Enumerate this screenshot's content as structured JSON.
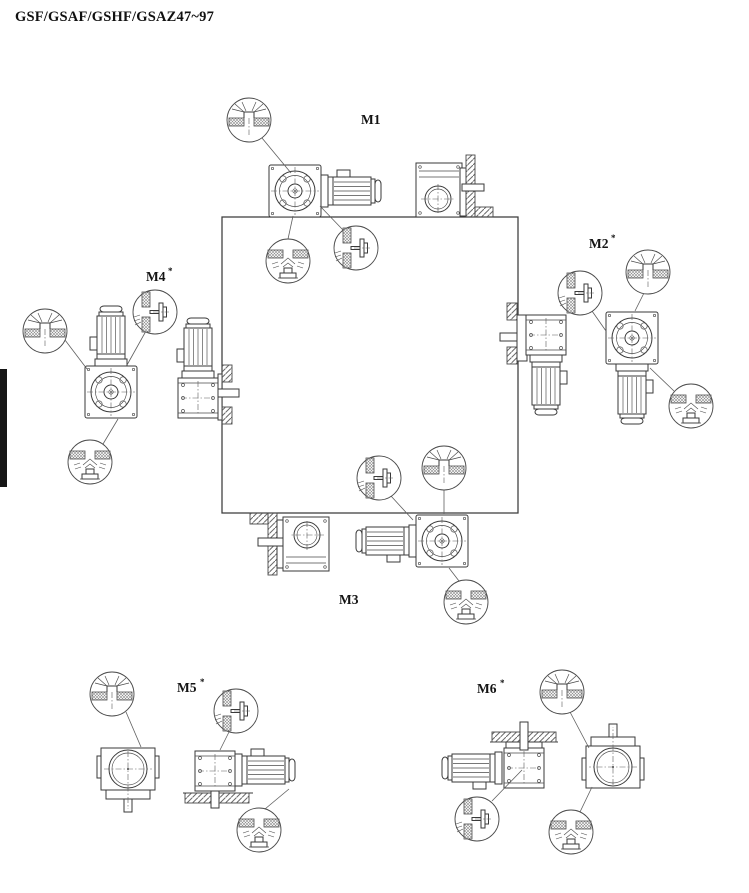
{
  "page": {
    "title": "GSF/GSAF/GSHF/GSAZ47~97"
  },
  "diagram": {
    "description": "Mounting position diagram for helical-bevel gearmotors, positions M1 to M6 arranged around a central square with plug-location callouts",
    "positions": [
      {
        "id": "M1",
        "label": "M1",
        "sup": ""
      },
      {
        "id": "M2",
        "label": "M2",
        "sup": "*"
      },
      {
        "id": "M3",
        "label": "M3",
        "sup": ""
      },
      {
        "id": "M4",
        "label": "M4",
        "sup": "*"
      },
      {
        "id": "M5",
        "label": "M5",
        "sup": "*"
      },
      {
        "id": "M6",
        "label": "M6",
        "sup": "*"
      }
    ],
    "callout_types": {
      "vent": "breather-vent-plug",
      "level": "oil-level-plug",
      "drain": "oil-drain-plug"
    },
    "colors": {
      "background": "#ffffff",
      "line": "#3a3a3a",
      "hatch": "#6a6a6a",
      "page_marker": "#161616"
    }
  }
}
